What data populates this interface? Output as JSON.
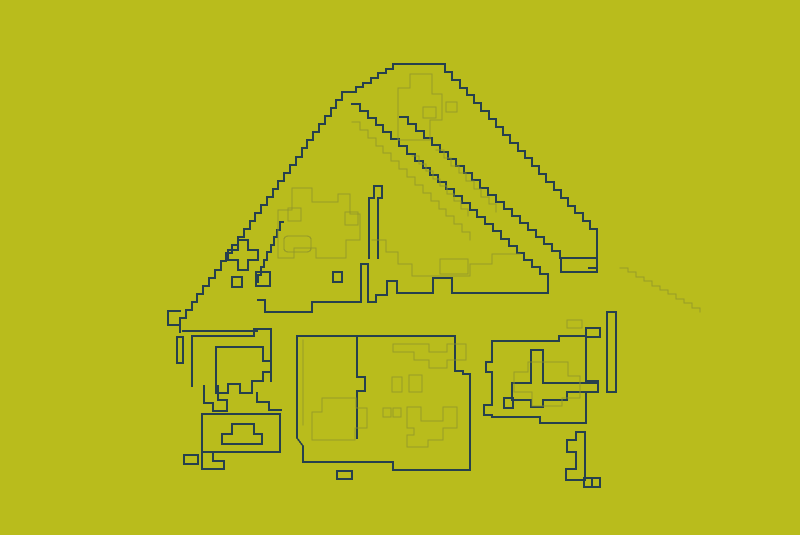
{
  "canvas": {
    "width": 800,
    "height": 535
  },
  "colors": {
    "background": "#b9bc1c",
    "line_dark": "#26404d",
    "line_faint": "#90942a"
  },
  "subject": "edge-contour line drawing of a house",
  "shapes": [
    {
      "name": "roof-left-edge",
      "stroke": "dark",
      "type": "stairs",
      "from": [
        348,
        92
      ],
      "to": [
        180,
        326
      ],
      "step": 8
    },
    {
      "name": "roof-left-tip",
      "stroke": "dark",
      "type": "path",
      "d": "M 180,311 H 168 V 325 H 180 V 332"
    },
    {
      "name": "roof-peak-steps",
      "stroke": "dark",
      "type": "stairs",
      "from": [
        348,
        92
      ],
      "to": [
        393,
        64
      ],
      "step": 7
    },
    {
      "name": "roof-peak-plateau",
      "stroke": "dark",
      "type": "path",
      "d": "M 393,64 H 438"
    },
    {
      "name": "roof-right-edge",
      "stroke": "dark",
      "type": "stairs",
      "from": [
        438,
        64
      ],
      "to": [
        597,
        237
      ],
      "step": 8
    },
    {
      "name": "roof-right-drop",
      "stroke": "dark",
      "type": "path",
      "d": "M 597,236 V 268 H 589"
    },
    {
      "name": "roof-eave-box",
      "stroke": "dark",
      "type": "rect",
      "x": 561,
      "y": 258,
      "w": 36,
      "h": 14
    },
    {
      "name": "roof-inner-diagonal-upper",
      "stroke": "dark",
      "type": "stairs",
      "from": [
        400,
        117
      ],
      "to": [
        560,
        258
      ],
      "step": 8
    },
    {
      "name": "roof-inner-diagonal-long",
      "stroke": "dark",
      "type": "stairs",
      "from": [
        352,
        104
      ],
      "to": [
        548,
        281
      ],
      "step": 8
    },
    {
      "name": "eave-line",
      "stroke": "dark",
      "type": "path",
      "d": "M 548,281 V 293 H 452 V 278 H 433 V 293 H 397 V 281 H 387 V 295 H 376 V 302 H 368 V 264 H 361 V 302 H 312 V 312 H 265 V 300 H 258"
    },
    {
      "name": "roof-vent",
      "stroke": "dark",
      "type": "path",
      "d": "M 369,258 V 198 H 374 V 186 H 382 V 198 H 378 V 258"
    },
    {
      "name": "plus-cluster",
      "stroke": "dark",
      "type": "path",
      "d": "M 238,240 H 248 V 250 H 258 V 260 H 248 V 270 H 238 V 260 H 228 V 250 H 238 Z"
    },
    {
      "name": "small-squares",
      "stroke": "dark",
      "type": "path",
      "d": "M 256,272 h 14 v 14 h -14 Z M 333,272 h 9 v 10 h -9 Z M 232,277 h 10 v 10 h -10 Z"
    },
    {
      "name": "inner-step-shape",
      "stroke": "dark",
      "type": "stairs",
      "from": [
        283,
        222
      ],
      "to": [
        258,
        282
      ],
      "step": 8
    },
    {
      "name": "left-ledge-line",
      "stroke": "dark",
      "type": "path",
      "d": "M 183,331 H 257"
    },
    {
      "name": "left-post",
      "stroke": "dark",
      "type": "rect",
      "x": 177,
      "y": 337,
      "w": 6,
      "h": 26
    },
    {
      "name": "left-window-frame",
      "stroke": "dark",
      "type": "path",
      "d": "M 192,386 V 336 H 254 V 329 H 271 V 381"
    },
    {
      "name": "left-window",
      "stroke": "dark",
      "type": "path",
      "d": "M 216,393 V 347 H 263 V 361 H 271 V 372 H 263 V 381 H 252 V 393 H 240 V 384 H 228 V 393 Z"
    },
    {
      "name": "left-window-foot",
      "stroke": "dark",
      "type": "path",
      "d": "M 204,386 V 403 H 213 V 411 H 227 V 400 H 218 V 386"
    },
    {
      "name": "left-window-step",
      "stroke": "dark",
      "type": "path",
      "d": "M 257,393 V 402 H 269 V 410 H 281"
    },
    {
      "name": "left-door-box",
      "stroke": "dark",
      "type": "rect",
      "x": 202,
      "y": 414,
      "w": 78,
      "h": 38
    },
    {
      "name": "left-door-mound",
      "stroke": "dark",
      "type": "path",
      "d": "M 222,444 V 434 H 232 V 424 H 254 V 434 H 262 V 444 Z"
    },
    {
      "name": "left-door-tiny-box",
      "stroke": "dark",
      "type": "rect",
      "x": 184,
      "y": 455,
      "w": 14,
      "h": 9
    },
    {
      "name": "left-door-foot",
      "stroke": "dark",
      "type": "path",
      "d": "M 202,452 V 469 H 224 V 461 H 213 V 452"
    },
    {
      "name": "center-box-outline",
      "stroke": "dark",
      "type": "path",
      "d": "M 297,336 H 455 V 371 H 463 V 374 H 470 V 470 H 393 V 462 H 303 V 446 L 297,438 Z"
    },
    {
      "name": "center-box-divider",
      "stroke": "dark",
      "type": "path",
      "d": "M 357,336 V 377 H 365 V 391 H 357 V 438"
    },
    {
      "name": "center-box-base-tab",
      "stroke": "dark",
      "type": "rect",
      "x": 337,
      "y": 471,
      "w": 15,
      "h": 8
    },
    {
      "name": "right-window-frame",
      "stroke": "dark",
      "type": "path",
      "d": "M 492,417 H 540 V 423 H 586 V 392 H 598 V 381 H 586 V 336 H 559 V 341 H 492 V 362 H 486 V 372 H 492 V 405 H 484 V 415 H 492 Z"
    },
    {
      "name": "right-window-cross",
      "stroke": "dark",
      "type": "path",
      "d": "M 531,350 H 543 V 383 H 598 V 392 H 567 V 400 H 543 V 407 H 531 V 400 H 512 V 383 H 531 Z"
    },
    {
      "name": "right-window-small-square",
      "stroke": "dark",
      "type": "rect",
      "x": 504,
      "y": 398,
      "w": 9,
      "h": 10
    },
    {
      "name": "right-top-box-dark",
      "stroke": "dark",
      "type": "rect",
      "x": 586,
      "y": 328,
      "w": 14,
      "h": 9
    },
    {
      "name": "right-slat",
      "stroke": "dark",
      "type": "rect",
      "x": 607,
      "y": 312,
      "w": 9,
      "h": 80
    },
    {
      "name": "bottom-bracket",
      "stroke": "dark",
      "type": "path",
      "d": "M 576,432 H 585 V 480 H 566 V 469 H 576 V 452 H 567 V 440 H 576 Z"
    },
    {
      "name": "bottom-bracket-squares",
      "stroke": "dark",
      "type": "path",
      "d": "M 584,478 h 8 v 9 h -8 Z M 592,478 h 8 v 9 h -8 Z"
    },
    {
      "name": "roof-texture-blob",
      "stroke": "faint",
      "type": "path",
      "d": "M 278,250 V 210 H 292 V 188 H 312 V 202 H 338 V 194 H 350 V 214 H 360 V 240 H 346 V 258 H 316 V 248 H 294 V 258 H 278 Z"
    },
    {
      "name": "roof-texture-oval",
      "stroke": "faint",
      "type": "path",
      "d": "M 289,236 H 306 Q 311,236 311,240 V 248 Q 311,252 306,252 H 289 Q 284,252 284,248 V 240 Q 284,236 289,236 Z"
    },
    {
      "name": "chimney-contour",
      "stroke": "faint",
      "type": "path",
      "d": "M 398,140 V 88 H 410 V 74 H 432 V 94 H 442 V 120 H 430 V 140 Z"
    },
    {
      "name": "chimney-rect",
      "stroke": "faint",
      "type": "rect",
      "x": 423,
      "y": 107,
      "w": 13,
      "h": 11
    },
    {
      "name": "chimney-square",
      "stroke": "faint",
      "type": "rect",
      "x": 446,
      "y": 102,
      "w": 11,
      "h": 10
    },
    {
      "name": "roof-faint-diagonal-1",
      "stroke": "faint",
      "type": "stairs",
      "from": [
        352,
        122
      ],
      "to": [
        470,
        240
      ],
      "step": 8
    },
    {
      "name": "roof-faint-diagonal-2",
      "stroke": "faint",
      "type": "stairs",
      "from": [
        412,
        156
      ],
      "to": [
        468,
        216
      ],
      "step": 8
    },
    {
      "name": "roof-faint-diagonal-3",
      "stroke": "faint",
      "type": "stairs",
      "from": [
        436,
        150
      ],
      "to": [
        496,
        212
      ],
      "step": 8
    },
    {
      "name": "eave-faint-box",
      "stroke": "faint",
      "type": "rect",
      "x": 440,
      "y": 259,
      "w": 28,
      "h": 15
    },
    {
      "name": "eave-texture",
      "stroke": "faint",
      "type": "path",
      "d": "M 372,240 H 386 V 252 H 398 V 264 H 412 V 276 H 470 V 264 H 492 V 254 H 520"
    },
    {
      "name": "roof-ghost-right",
      "stroke": "faint",
      "type": "stairs",
      "from": [
        620,
        268
      ],
      "to": [
        700,
        312
      ],
      "step": 8,
      "opacity": 0.35
    },
    {
      "name": "roof-small-rects",
      "stroke": "faint",
      "type": "path",
      "d": "M 288,208 h 13 v 13 h -13 Z M 345,212 h 13 v 13 h -13 Z"
    },
    {
      "name": "center-box-top-blob",
      "stroke": "faint",
      "type": "path",
      "d": "M 393,352 V 344 H 429 V 352 H 447 V 344 H 466 V 360 H 447 V 368 H 429 V 360 H 414 V 352 Z"
    },
    {
      "name": "center-box-rects",
      "stroke": "faint",
      "type": "path",
      "d": "M 392,377 h 10 v 15 h -10 Z M 409,375 h 13 v 17 h -13 Z"
    },
    {
      "name": "center-box-cross",
      "stroke": "faint",
      "type": "path",
      "d": "M 407,407 H 421 V 421 H 443 V 407 H 457 V 428 H 443 V 440 H 428 V 447 H 407 V 435 H 414 V 428 H 407 Z"
    },
    {
      "name": "center-box-pair",
      "stroke": "faint",
      "type": "path",
      "d": "M 383,408 h 8 v 9 h -8 Z M 393,408 h 8 v 9 h -8 Z"
    },
    {
      "name": "center-box-arch",
      "stroke": "faint",
      "type": "path",
      "d": "M 312,440 V 412 H 322 V 398 H 356 V 408 H 367 V 428 H 355 V 440 Z"
    },
    {
      "name": "center-box-inner-edge",
      "stroke": "faint",
      "type": "path",
      "d": "M 303,340 V 425"
    },
    {
      "name": "right-window-inner",
      "stroke": "faint",
      "type": "path",
      "d": "M 514,372 H 528 V 362 H 568 V 376 H 580 V 398 H 562 V 406 H 532 V 392 H 514 Z"
    },
    {
      "name": "right-top-box-faint",
      "stroke": "faint",
      "type": "rect",
      "x": 567,
      "y": 320,
      "w": 15,
      "h": 8
    }
  ]
}
